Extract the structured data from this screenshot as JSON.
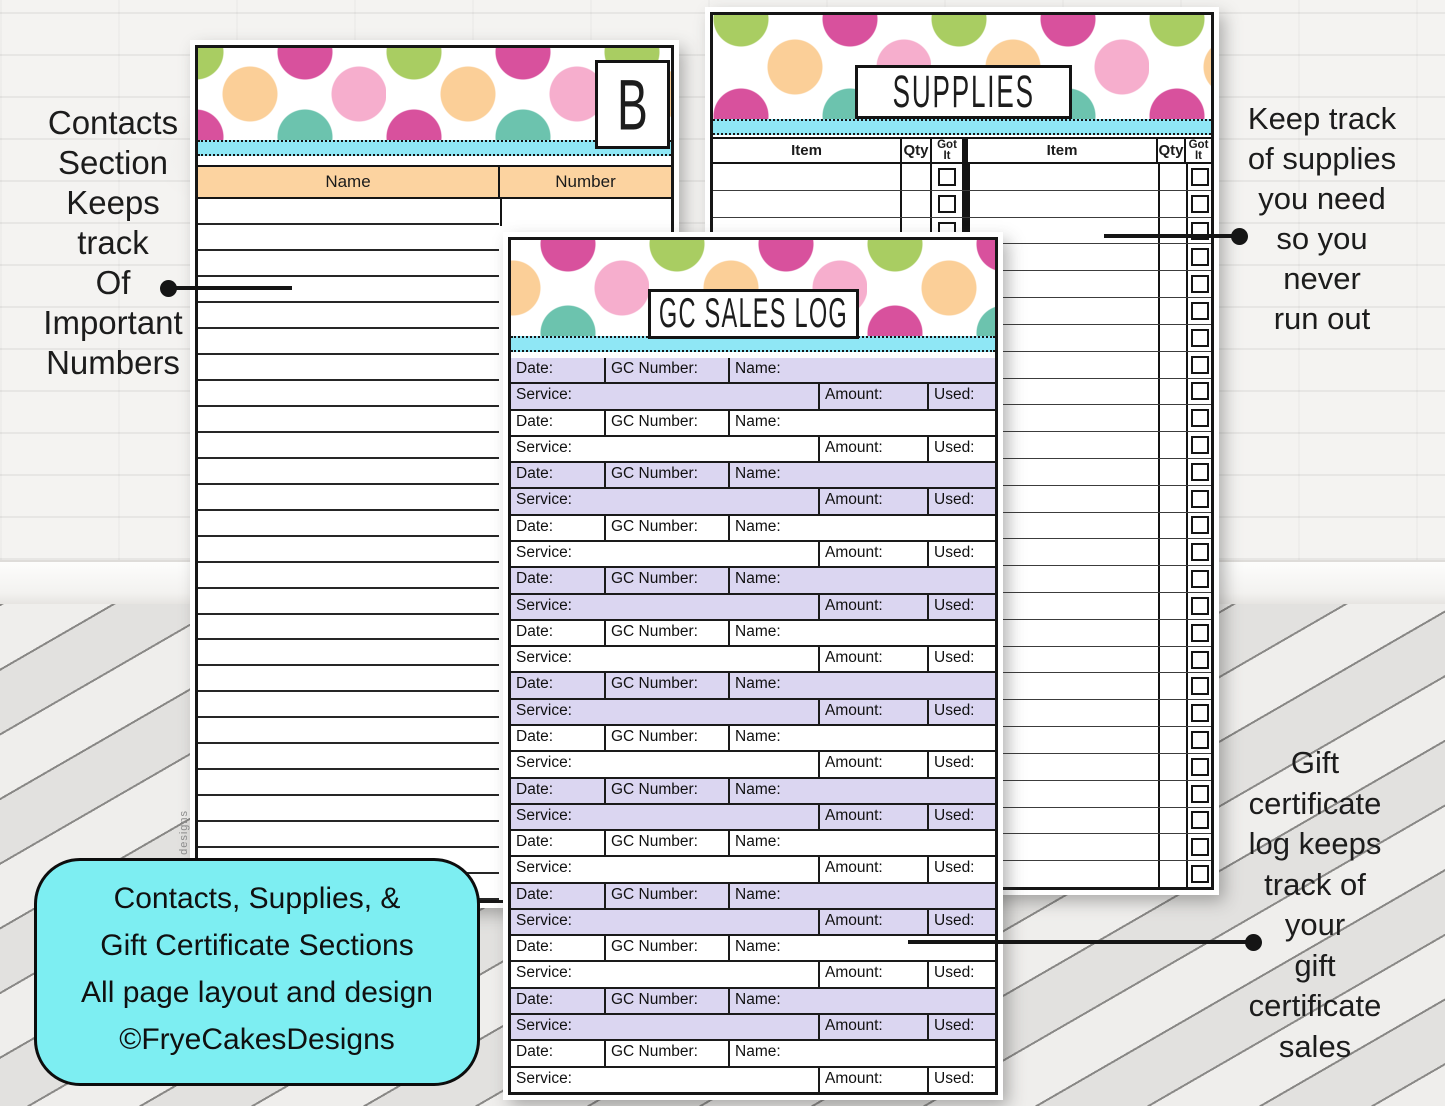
{
  "left_note": {
    "lines": [
      "Contacts",
      "Section",
      "Keeps",
      "track",
      "Of",
      "Important",
      "Numbers"
    ]
  },
  "supplies_note": {
    "lines": [
      "Keep track",
      "of supplies",
      "you need",
      "so you",
      "never",
      "run out"
    ]
  },
  "gc_note": {
    "lines": [
      "Gift",
      "certificate",
      "log keeps",
      "track of",
      "your",
      "gift",
      "certificate",
      "sales"
    ]
  },
  "caption": {
    "lines": [
      "Contacts, Supplies, &",
      "Gift Certificate Sections",
      "All page layout and design",
      "©FryeCakesDesigns"
    ]
  },
  "contacts_page": {
    "tab_letter": "B",
    "columns": [
      "Name",
      "Number"
    ],
    "row_count": 27,
    "watermark": "designs"
  },
  "supplies_page": {
    "title": "SUPPLIES",
    "columns": [
      "Item",
      "Qty",
      "Got It"
    ],
    "got_split": [
      "Got",
      "It"
    ],
    "row_count": 27
  },
  "gc_page": {
    "title": "GC SALES LOG",
    "pair_count": 14,
    "row_labels": {
      "date": "Date:",
      "gc_number": "GC Number:",
      "name": "Name:",
      "service": "Service:",
      "amount": "Amount:",
      "used": "Used:"
    }
  },
  "colors": {
    "cyan_stripe": "#8fe7f5",
    "cyan_box": "#7deef2",
    "peach_header": "#fcd3a0",
    "lavender_row": "#dbd6f1",
    "dot_green": "#a9cd62",
    "dot_magenta": "#d8519d",
    "dot_pink": "#f6aecd",
    "dot_pale_pink": "#f9c6dc",
    "dot_peach": "#fbcf98",
    "dot_teal": "#6cc3ae"
  }
}
